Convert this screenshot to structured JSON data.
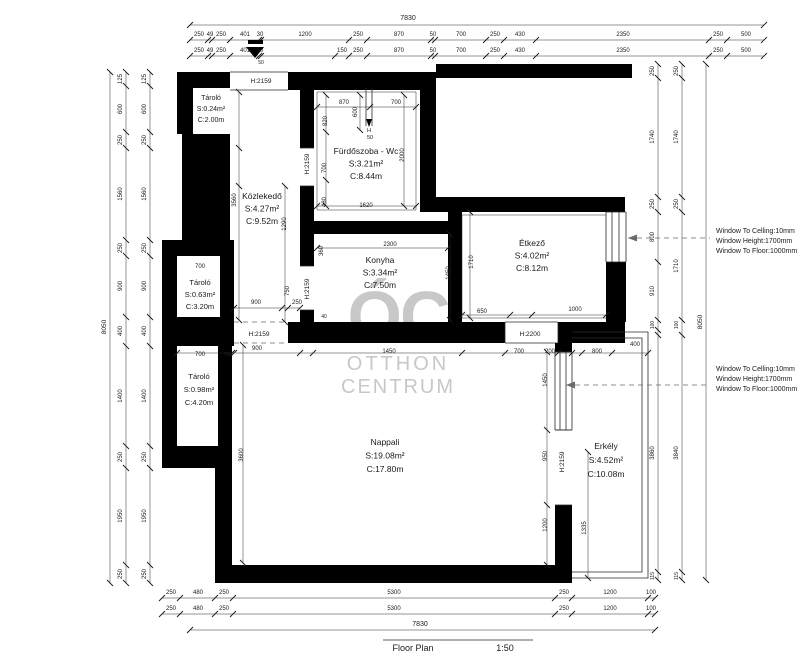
{
  "footer": {
    "title": "Floor Plan",
    "scale": "1:50"
  },
  "watermark": {
    "monogram": "ÓC",
    "line1": "OTTHON",
    "line2": "CENTRUM",
    "color": "#c8c8c8"
  },
  "north_arrow": {
    "name": "entrance-arrow"
  },
  "rooms": [
    {
      "slug": "tarolo-1",
      "name": "Tároló",
      "area": "S:0.24m²",
      "height": "C:2.00m",
      "x": 211,
      "y": 100,
      "lh": 11,
      "s": 7
    },
    {
      "slug": "kozlekedo",
      "name": "Közlekedő",
      "area": "S:4.27m²",
      "height": "C:9.52m",
      "x": 262,
      "y": 199,
      "lh": 12.5,
      "s": 8.5
    },
    {
      "slug": "furdoszoba",
      "name": "Fürdőszoba - Wc",
      "area": "S:3.21m²",
      "height": "C:8.44m",
      "x": 366,
      "y": 154,
      "lh": 12.5,
      "s": 8.5
    },
    {
      "slug": "konyha",
      "name": "Konyha",
      "area": "S:3.34m²",
      "height": "C:7.50m",
      "x": 380,
      "y": 263,
      "lh": 12.5,
      "s": 8.5
    },
    {
      "slug": "etkezo",
      "name": "Étkező",
      "area": "S:4.02m²",
      "height": "C:8.12m",
      "x": 532,
      "y": 246,
      "lh": 12.5,
      "s": 8.5
    },
    {
      "slug": "tarolo-2",
      "name": "Tároló",
      "area": "S:0.63m²",
      "height": "C:3.20m",
      "x": 200,
      "y": 285,
      "lh": 12,
      "s": 7.5
    },
    {
      "slug": "tarolo-3",
      "name": "Tároló",
      "area": "S:0.98m²",
      "height": "C:4.20m",
      "x": 199,
      "y": 379,
      "lh": 13,
      "s": 7.5
    },
    {
      "slug": "nappali",
      "name": "Nappali",
      "area": "S:19.08m²",
      "height": "C:17.80m",
      "x": 385,
      "y": 445,
      "lh": 13.5,
      "s": 8.5
    },
    {
      "slug": "erkely",
      "name": "Erkély",
      "area": "S:4.52m²",
      "height": "C:10.08m",
      "x": 606,
      "y": 449,
      "lh": 14,
      "s": 8.5
    }
  ],
  "window_notes": [
    {
      "x": 716,
      "y": 233,
      "lh": 10,
      "lines": [
        "Window To Celling:10mm",
        "Window Height:1700mm",
        "Window To Floor:1000mm"
      ]
    },
    {
      "x": 716,
      "y": 371,
      "lh": 10,
      "lines": [
        "Window To Celling:10mm",
        "Window Height:1700mm",
        "Window To Floor:1000mm"
      ]
    }
  ],
  "dim_labels": [
    {
      "t": "7830",
      "x": 408,
      "y": 20,
      "s": 7
    },
    {
      "t": "250",
      "x": 199,
      "y": 36
    },
    {
      "t": "49",
      "x": 210,
      "y": 36
    },
    {
      "t": "250",
      "x": 221,
      "y": 36
    },
    {
      "t": "401",
      "x": 245,
      "y": 36
    },
    {
      "t": "30",
      "x": 260,
      "y": 36
    },
    {
      "t": "1200",
      "x": 305,
      "y": 36
    },
    {
      "t": "250",
      "x": 358,
      "y": 36
    },
    {
      "t": "870",
      "x": 399,
      "y": 36
    },
    {
      "t": "50",
      "x": 433,
      "y": 36
    },
    {
      "t": "700",
      "x": 461,
      "y": 36
    },
    {
      "t": "250",
      "x": 495,
      "y": 36
    },
    {
      "t": "430",
      "x": 520,
      "y": 36
    },
    {
      "t": "2350",
      "x": 623,
      "y": 36
    },
    {
      "t": "250",
      "x": 718,
      "y": 36
    },
    {
      "t": "500",
      "x": 746,
      "y": 36
    },
    {
      "t": "250",
      "x": 199,
      "y": 52
    },
    {
      "t": "49",
      "x": 210,
      "y": 52
    },
    {
      "t": "250",
      "x": 221,
      "y": 52
    },
    {
      "t": "401",
      "x": 245,
      "y": 52
    },
    {
      "t": "50",
      "x": 260,
      "y": 52
    },
    {
      "t": "150",
      "x": 342,
      "y": 52
    },
    {
      "t": "250",
      "x": 358,
      "y": 52
    },
    {
      "t": "870",
      "x": 399,
      "y": 52
    },
    {
      "t": "50",
      "x": 433,
      "y": 52
    },
    {
      "t": "700",
      "x": 461,
      "y": 52
    },
    {
      "t": "250",
      "x": 495,
      "y": 52
    },
    {
      "t": "430",
      "x": 520,
      "y": 52
    },
    {
      "t": "2350",
      "x": 623,
      "y": 52
    },
    {
      "t": "250",
      "x": 718,
      "y": 52
    },
    {
      "t": "500",
      "x": 746,
      "y": 52
    },
    {
      "t": "50",
      "x": 261,
      "y": 64,
      "s": 5
    },
    {
      "t": "125",
      "x": 122,
      "y": 79,
      "r": 1
    },
    {
      "t": "600",
      "x": 122,
      "y": 109,
      "r": 1
    },
    {
      "t": "250",
      "x": 122,
      "y": 140,
      "r": 1
    },
    {
      "t": "1560",
      "x": 122,
      "y": 194,
      "r": 1
    },
    {
      "t": "250",
      "x": 122,
      "y": 248,
      "r": 1
    },
    {
      "t": "900",
      "x": 122,
      "y": 286,
      "r": 1
    },
    {
      "t": "400",
      "x": 122,
      "y": 331,
      "r": 1
    },
    {
      "t": "1400",
      "x": 122,
      "y": 396,
      "r": 1
    },
    {
      "t": "250",
      "x": 122,
      "y": 457,
      "r": 1
    },
    {
      "t": "1950",
      "x": 122,
      "y": 516,
      "r": 1
    },
    {
      "t": "250",
      "x": 122,
      "y": 574,
      "r": 1
    },
    {
      "t": "125",
      "x": 146,
      "y": 79,
      "r": 1
    },
    {
      "t": "600",
      "x": 146,
      "y": 109,
      "r": 1
    },
    {
      "t": "250",
      "x": 146,
      "y": 140,
      "r": 1
    },
    {
      "t": "1560",
      "x": 146,
      "y": 194,
      "r": 1
    },
    {
      "t": "250",
      "x": 146,
      "y": 248,
      "r": 1
    },
    {
      "t": "900",
      "x": 146,
      "y": 286,
      "r": 1
    },
    {
      "t": "400",
      "x": 146,
      "y": 331,
      "r": 1
    },
    {
      "t": "1400",
      "x": 146,
      "y": 396,
      "r": 1
    },
    {
      "t": "250",
      "x": 146,
      "y": 457,
      "r": 1
    },
    {
      "t": "1950",
      "x": 146,
      "y": 516,
      "r": 1
    },
    {
      "t": "250",
      "x": 146,
      "y": 574,
      "r": 1
    },
    {
      "t": "8050",
      "x": 106,
      "y": 327,
      "r": 1,
      "s": 6.5
    },
    {
      "t": "250",
      "x": 654,
      "y": 71,
      "r": 1
    },
    {
      "t": "1740",
      "x": 654,
      "y": 137,
      "r": 1
    },
    {
      "t": "250",
      "x": 654,
      "y": 204,
      "r": 1
    },
    {
      "t": "800",
      "x": 654,
      "y": 237,
      "r": 1
    },
    {
      "t": "910",
      "x": 654,
      "y": 291,
      "r": 1
    },
    {
      "t": "100",
      "x": 654,
      "y": 325,
      "r": 1,
      "s": 5
    },
    {
      "t": "3860",
      "x": 654,
      "y": 453,
      "r": 1
    },
    {
      "t": "115",
      "x": 654,
      "y": 576,
      "r": 1,
      "s": 5
    },
    {
      "t": "250",
      "x": 678,
      "y": 71,
      "r": 1
    },
    {
      "t": "1740",
      "x": 678,
      "y": 137,
      "r": 1
    },
    {
      "t": "250",
      "x": 678,
      "y": 204,
      "r": 1
    },
    {
      "t": "1710",
      "x": 678,
      "y": 266,
      "r": 1
    },
    {
      "t": "100",
      "x": 678,
      "y": 325,
      "r": 1,
      "s": 5
    },
    {
      "t": "3840",
      "x": 678,
      "y": 453,
      "r": 1
    },
    {
      "t": "115",
      "x": 678,
      "y": 576,
      "r": 1,
      "s": 5
    },
    {
      "t": "8050",
      "x": 702,
      "y": 322,
      "r": 1,
      "s": 6.5
    },
    {
      "t": "250",
      "x": 171,
      "y": 594
    },
    {
      "t": "480",
      "x": 198,
      "y": 594
    },
    {
      "t": "250",
      "x": 224,
      "y": 594
    },
    {
      "t": "5300",
      "x": 394,
      "y": 594
    },
    {
      "t": "250",
      "x": 564,
      "y": 594
    },
    {
      "t": "1200",
      "x": 610,
      "y": 594
    },
    {
      "t": "100",
      "x": 651,
      "y": 594
    },
    {
      "t": "250",
      "x": 171,
      "y": 610
    },
    {
      "t": "480",
      "x": 198,
      "y": 610
    },
    {
      "t": "250",
      "x": 224,
      "y": 610
    },
    {
      "t": "5300",
      "x": 394,
      "y": 610
    },
    {
      "t": "250",
      "x": 564,
      "y": 610
    },
    {
      "t": "1200",
      "x": 610,
      "y": 610
    },
    {
      "t": "100",
      "x": 651,
      "y": 610
    },
    {
      "t": "7830",
      "x": 420,
      "y": 626,
      "s": 7
    },
    {
      "t": "870",
      "x": 344,
      "y": 104
    },
    {
      "t": "600",
      "x": 357,
      "y": 112,
      "r": 1
    },
    {
      "t": "700",
      "x": 396,
      "y": 104
    },
    {
      "t": "820",
      "x": 327,
      "y": 121,
      "r": 1
    },
    {
      "t": "H",
      "x": 369,
      "y": 132,
      "s": 5.5
    },
    {
      "t": "50",
      "x": 370,
      "y": 139,
      "s": 5.5
    },
    {
      "t": "700",
      "x": 326,
      "y": 168,
      "r": 1
    },
    {
      "t": "2000",
      "x": 404,
      "y": 155,
      "r": 1
    },
    {
      "t": "480",
      "x": 326,
      "y": 202,
      "r": 1
    },
    {
      "t": "1620",
      "x": 366,
      "y": 207
    },
    {
      "t": "3560",
      "x": 236,
      "y": 200,
      "r": 1
    },
    {
      "t": "1290",
      "x": 286,
      "y": 224,
      "r": 1
    },
    {
      "t": "900",
      "x": 256,
      "y": 304
    },
    {
      "t": "750",
      "x": 289,
      "y": 291,
      "r": 1
    },
    {
      "t": "250",
      "x": 297,
      "y": 304
    },
    {
      "t": "2300",
      "x": 390,
      "y": 246
    },
    {
      "t": "360",
      "x": 323,
      "y": 251,
      "r": 1
    },
    {
      "t": "1450",
      "x": 450,
      "y": 273,
      "r": 1
    },
    {
      "t": "40",
      "x": 324,
      "y": 318,
      "s": 5
    },
    {
      "t": "1710",
      "x": 473,
      "y": 262,
      "r": 1
    },
    {
      "t": "650",
      "x": 482,
      "y": 313
    },
    {
      "t": "1000",
      "x": 575,
      "y": 311
    },
    {
      "t": "700",
      "x": 200,
      "y": 268
    },
    {
      "t": "700",
      "x": 200,
      "y": 356
    },
    {
      "t": "50",
      "x": 227,
      "y": 356,
      "s": 5
    },
    {
      "t": "900",
      "x": 257,
      "y": 350
    },
    {
      "t": "1450",
      "x": 389,
      "y": 353
    },
    {
      "t": "700",
      "x": 519,
      "y": 353
    },
    {
      "t": "200",
      "x": 550,
      "y": 353
    },
    {
      "t": "800",
      "x": 597,
      "y": 353
    },
    {
      "t": "400",
      "x": 635,
      "y": 346
    },
    {
      "t": "3600",
      "x": 243,
      "y": 455,
      "r": 1
    },
    {
      "t": "1450",
      "x": 547,
      "y": 380,
      "r": 1
    },
    {
      "t": "950",
      "x": 547,
      "y": 456,
      "r": 1
    },
    {
      "t": "1200",
      "x": 547,
      "y": 525,
      "r": 1
    },
    {
      "t": "1335",
      "x": 586,
      "y": 528,
      "r": 1
    },
    {
      "t": "H:2159",
      "x": 261,
      "y": 83,
      "s": 6.5
    },
    {
      "t": "H:2159",
      "x": 309,
      "y": 164,
      "r": 1,
      "s": 6.5
    },
    {
      "t": "H:2159",
      "x": 309,
      "y": 289,
      "r": 1,
      "s": 6.5
    },
    {
      "t": "H:2159",
      "x": 259,
      "y": 336,
      "s": 6.5
    },
    {
      "t": "H:2200",
      "x": 530,
      "y": 336,
      "s": 6.5
    },
    {
      "t": "H:2159",
      "x": 564,
      "y": 462,
      "r": 1,
      "s": 6.5
    }
  ]
}
